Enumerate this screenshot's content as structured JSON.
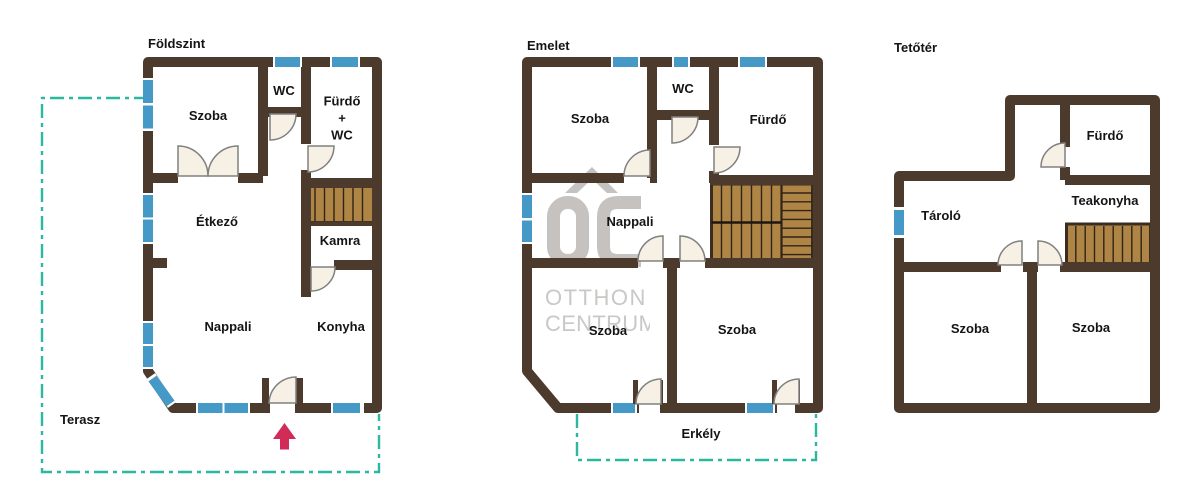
{
  "watermark": {
    "logo": "OC",
    "line1": "OTTHON",
    "line2": "CENTRUM"
  },
  "plans": {
    "foldszint": {
      "title": "Földszint",
      "terasz": "Terasz",
      "rooms": {
        "szoba": "Szoba",
        "wc": "WC",
        "furdo_wc": "Fürdő\n+\nWC",
        "etkezo": "Étkező",
        "kamra": "Kamra",
        "nappali": "Nappali",
        "konyha": "Konyha"
      }
    },
    "emelet": {
      "title": "Emelet",
      "erkely": "Erkély",
      "rooms": {
        "szoba_top": "Szoba",
        "wc": "WC",
        "furdo": "Fürdő",
        "nappali": "Nappali",
        "szoba_left": "Szoba",
        "szoba_right": "Szoba"
      }
    },
    "tetoter": {
      "title": "Tetőtér",
      "rooms": {
        "furdo": "Fürdő",
        "tarolo": "Tároló",
        "teakonyha": "Teakonyha",
        "szoba_left": "Szoba",
        "szoba_right": "Szoba"
      }
    }
  },
  "colors": {
    "wall": "#4c3a2d",
    "window_blue": "#4599c7",
    "stairs_wood": "#ae8545",
    "stairs_line": "#30241a",
    "door_fill": "#f7f0e4",
    "door_stroke": "#808080",
    "outline_teal": "#2bb7a0",
    "arrow_red": "#d12b57",
    "watermark_gray": "#c5c2bf",
    "label_text": "#141414"
  }
}
